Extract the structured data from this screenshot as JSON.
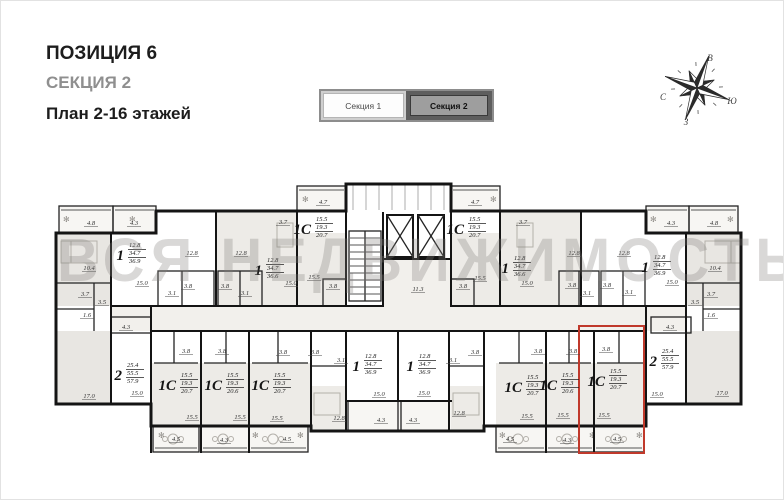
{
  "header": {
    "position_label": "ПОЗИЦИЯ 6",
    "section_label": "СЕКЦИЯ 2",
    "plan_label": "План 2-16 этажей"
  },
  "tabs": {
    "items": [
      {
        "label": "Секция 1",
        "active": false
      },
      {
        "label": "Секция 2",
        "active": true
      }
    ]
  },
  "compass": {
    "north": "С",
    "south": "Ю",
    "east": "В",
    "west": "З"
  },
  "watermark": {
    "text": "ВСЯ НЕДВИЖИМОСТЬ"
  },
  "plan": {
    "highlight": {
      "color": "#c0392b"
    },
    "apartments": [
      {
        "type": "1",
        "areas": [
          "12.8",
          "34.7",
          "36.9"
        ],
        "x": 126,
        "y": 248
      },
      {
        "type": "1",
        "areas": [
          "12.8",
          "34.7",
          "36.6"
        ],
        "x": 264,
        "y": 263
      },
      {
        "type": "1С",
        "areas": [
          "15.5",
          "19.3",
          "20.7"
        ],
        "x": 313,
        "y": 222
      },
      {
        "type": "1С",
        "areas": [
          "15.5",
          "19.3",
          "20.7"
        ],
        "x": 466,
        "y": 222
      },
      {
        "type": "1",
        "areas": [
          "12.8",
          "34.7",
          "36.6"
        ],
        "x": 511,
        "y": 261
      },
      {
        "type": "1",
        "areas": [
          "12.8",
          "34.7",
          "36.9"
        ],
        "x": 651,
        "y": 260
      },
      {
        "type": "2",
        "areas": [
          "25.4",
          "55.5",
          "57.9"
        ],
        "x": 124,
        "y": 368
      },
      {
        "type": "1С",
        "areas": [
          "15.5",
          "19.3",
          "20.7"
        ],
        "x": 178,
        "y": 378
      },
      {
        "type": "1С",
        "areas": [
          "15.5",
          "19.3",
          "20.6"
        ],
        "x": 224,
        "y": 378
      },
      {
        "type": "1С",
        "areas": [
          "15.5",
          "19.3",
          "20.7"
        ],
        "x": 271,
        "y": 378
      },
      {
        "type": "1",
        "areas": [
          "12.8",
          "34.7",
          "36.9"
        ],
        "x": 362,
        "y": 359
      },
      {
        "type": "1",
        "areas": [
          "12.8",
          "34.7",
          "36.9"
        ],
        "x": 416,
        "y": 359
      },
      {
        "type": "1С",
        "areas": [
          "15.5",
          "19.3",
          "20.7"
        ],
        "x": 524,
        "y": 380
      },
      {
        "type": "1С",
        "areas": [
          "15.5",
          "19.3",
          "20.6"
        ],
        "x": 559,
        "y": 378
      },
      {
        "type": "1С",
        "areas": [
          "15.5",
          "19.3",
          "20.7"
        ],
        "x": 607,
        "y": 374,
        "highlighted": true
      },
      {
        "type": "2",
        "areas": [
          "25.4",
          "55.5",
          "57.9"
        ],
        "x": 659,
        "y": 354
      }
    ],
    "room_labels": [
      {
        "t": "4.8",
        "x": 90,
        "y": 224
      },
      {
        "t": "4.3",
        "x": 133,
        "y": 224
      },
      {
        "t": "10.4",
        "x": 88,
        "y": 269
      },
      {
        "t": "3.7",
        "x": 84,
        "y": 295
      },
      {
        "t": "3.5",
        "x": 101,
        "y": 303
      },
      {
        "t": "1.6",
        "x": 86,
        "y": 316
      },
      {
        "t": "12.8",
        "x": 191,
        "y": 254
      },
      {
        "t": "15.0",
        "x": 141,
        "y": 284
      },
      {
        "t": "3.1",
        "x": 171,
        "y": 294
      },
      {
        "t": "3.8",
        "x": 187,
        "y": 287
      },
      {
        "t": "12.8",
        "x": 240,
        "y": 254
      },
      {
        "t": "3.8",
        "x": 224,
        "y": 287
      },
      {
        "t": "3.1",
        "x": 244,
        "y": 294
      },
      {
        "t": "15.0",
        "x": 290,
        "y": 284
      },
      {
        "t": "3.7",
        "x": 282,
        "y": 223
      },
      {
        "t": "4.7",
        "x": 322,
        "y": 203
      },
      {
        "t": "15.5",
        "x": 313,
        "y": 278
      },
      {
        "t": "3.8",
        "x": 332,
        "y": 287
      },
      {
        "t": "11.3",
        "x": 417,
        "y": 290
      },
      {
        "t": "4.7",
        "x": 474,
        "y": 203
      },
      {
        "t": "15.5",
        "x": 479,
        "y": 279
      },
      {
        "t": "3.8",
        "x": 462,
        "y": 287
      },
      {
        "t": "3.7",
        "x": 522,
        "y": 223
      },
      {
        "t": "15.0",
        "x": 526,
        "y": 284
      },
      {
        "t": "12.8",
        "x": 573,
        "y": 254
      },
      {
        "t": "3.8",
        "x": 571,
        "y": 286
      },
      {
        "t": "3.1",
        "x": 586,
        "y": 294
      },
      {
        "t": "12.8",
        "x": 623,
        "y": 254
      },
      {
        "t": "3.8",
        "x": 606,
        "y": 286
      },
      {
        "t": "3.1",
        "x": 628,
        "y": 293
      },
      {
        "t": "15.0",
        "x": 671,
        "y": 283
      },
      {
        "t": "4.3",
        "x": 670,
        "y": 224
      },
      {
        "t": "4.8",
        "x": 713,
        "y": 224
      },
      {
        "t": "10.4",
        "x": 714,
        "y": 269
      },
      {
        "t": "3.7",
        "x": 710,
        "y": 295
      },
      {
        "t": "3.5",
        "x": 694,
        "y": 303
      },
      {
        "t": "1.6",
        "x": 710,
        "y": 316
      },
      {
        "t": "4.3",
        "x": 125,
        "y": 328
      },
      {
        "t": "17.0",
        "x": 88,
        "y": 397
      },
      {
        "t": "15.0",
        "x": 136,
        "y": 394
      },
      {
        "t": "3.8",
        "x": 185,
        "y": 352
      },
      {
        "t": "15.5",
        "x": 191,
        "y": 418
      },
      {
        "t": "4.5",
        "x": 175,
        "y": 440
      },
      {
        "t": "3.8",
        "x": 221,
        "y": 352
      },
      {
        "t": "15.5",
        "x": 239,
        "y": 418
      },
      {
        "t": "4.3",
        "x": 223,
        "y": 441
      },
      {
        "t": "3.8",
        "x": 282,
        "y": 353
      },
      {
        "t": "15.5",
        "x": 276,
        "y": 419
      },
      {
        "t": "4.5",
        "x": 286,
        "y": 440
      },
      {
        "t": "3.8",
        "x": 314,
        "y": 353
      },
      {
        "t": "3.1",
        "x": 340,
        "y": 361
      },
      {
        "t": "15.0",
        "x": 378,
        "y": 395
      },
      {
        "t": "12.8",
        "x": 338,
        "y": 419
      },
      {
        "t": "4.3",
        "x": 380,
        "y": 421
      },
      {
        "t": "3.8",
        "x": 474,
        "y": 353
      },
      {
        "t": "3.1",
        "x": 452,
        "y": 361
      },
      {
        "t": "15.0",
        "x": 423,
        "y": 394
      },
      {
        "t": "12.8",
        "x": 458,
        "y": 414
      },
      {
        "t": "4.3",
        "x": 412,
        "y": 421
      },
      {
        "t": "3.8",
        "x": 537,
        "y": 352
      },
      {
        "t": "15.5",
        "x": 526,
        "y": 417
      },
      {
        "t": "4.5",
        "x": 509,
        "y": 440
      },
      {
        "t": "3.8",
        "x": 572,
        "y": 352
      },
      {
        "t": "15.5",
        "x": 562,
        "y": 416
      },
      {
        "t": "4.3",
        "x": 566,
        "y": 441
      },
      {
        "t": "3.8",
        "x": 605,
        "y": 350
      },
      {
        "t": "15.5",
        "x": 603,
        "y": 416
      },
      {
        "t": "4.5",
        "x": 616,
        "y": 440
      },
      {
        "t": "4.3",
        "x": 669,
        "y": 328
      },
      {
        "t": "15.0",
        "x": 656,
        "y": 395
      },
      {
        "t": "17.0",
        "x": 721,
        "y": 394
      }
    ]
  }
}
